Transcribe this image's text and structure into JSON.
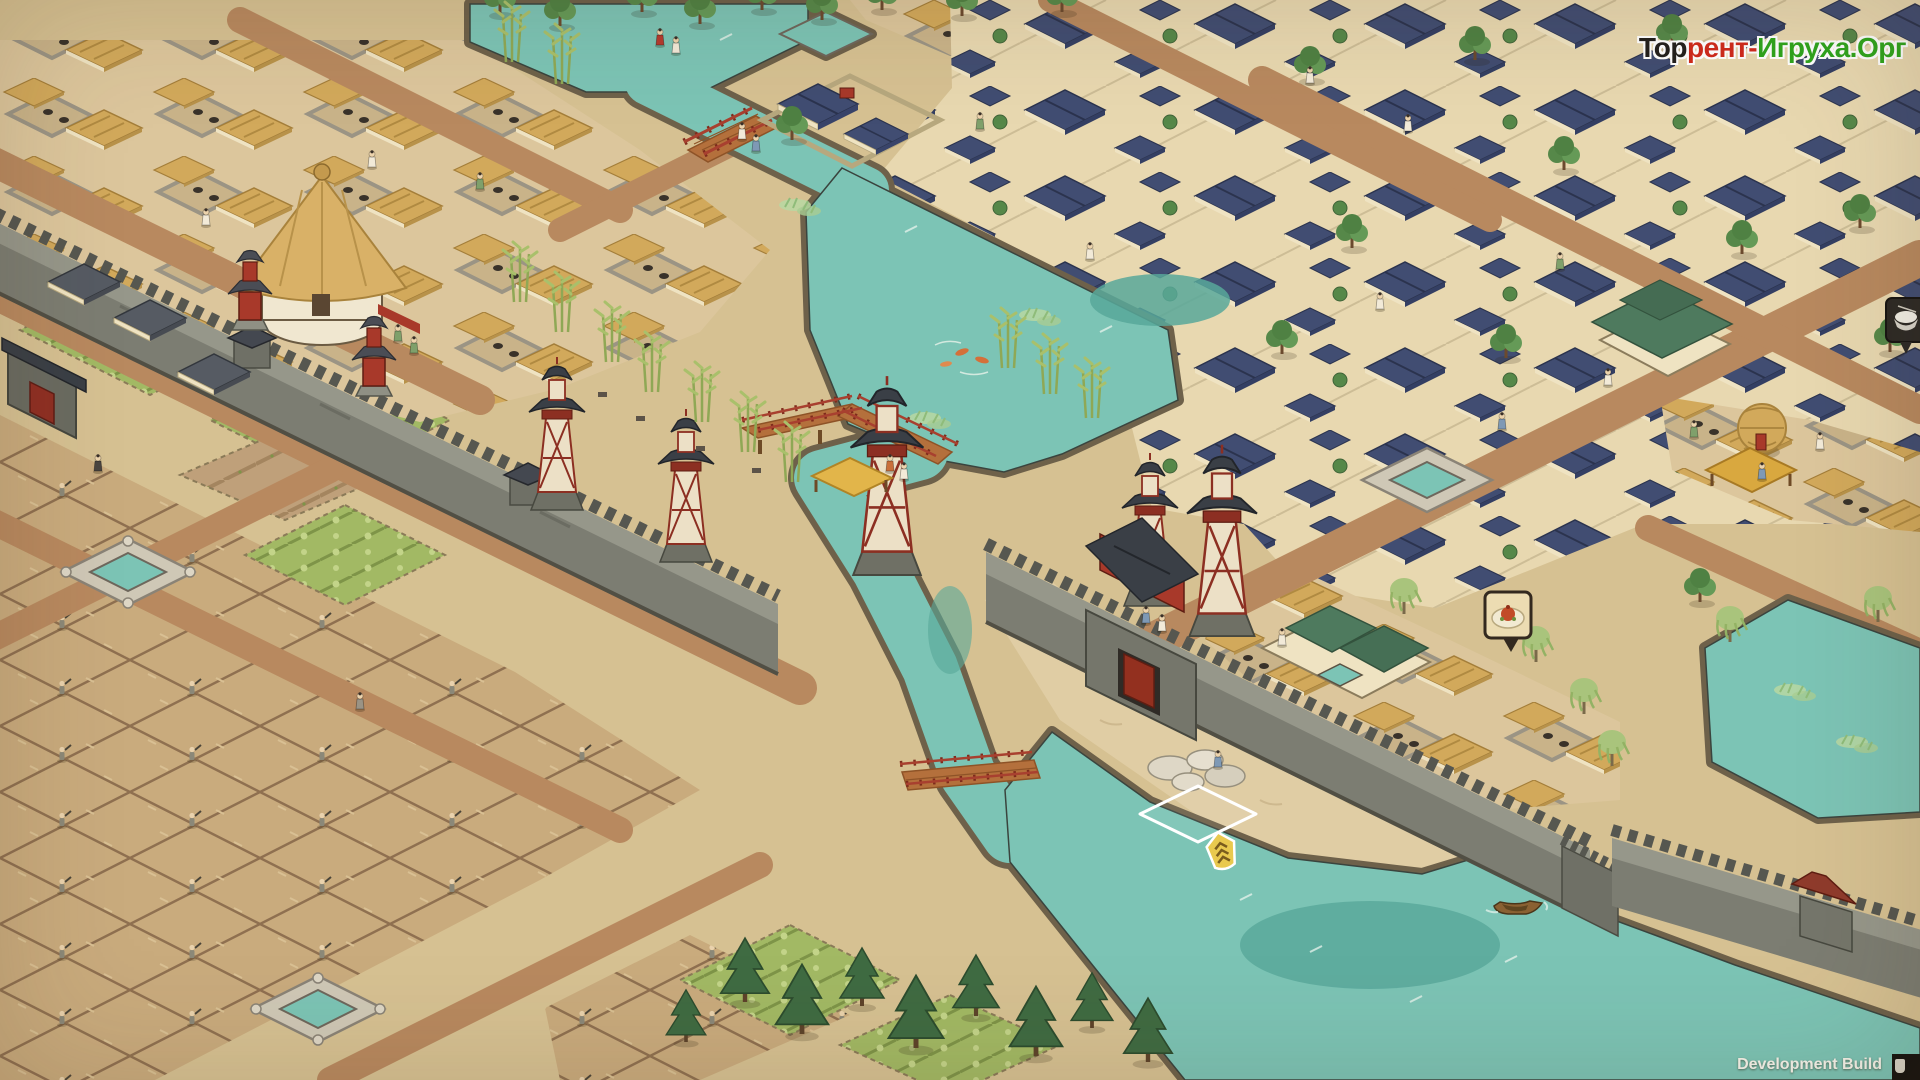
{
  "overlay": {
    "watermark": {
      "segments": [
        {
          "text": "Тор",
          "color": "#23201d"
        },
        {
          "text": "рент-",
          "color": "#d02a1c"
        },
        {
          "text": "Игруха.Орг",
          "color": "#2fa51d"
        }
      ]
    },
    "build_label": "Development Build"
  },
  "markers": {
    "food_bubble": {
      "icon": "food-dish-icon"
    },
    "bowl_bubble": {
      "icon": "rice-bowl-icon"
    },
    "boat_badge": {
      "icon": "boat-badge-icon"
    },
    "tile_cursor": {
      "shape": "diamond-outline",
      "color": "#ffffff"
    }
  },
  "palette": {
    "ground": "#d6c192",
    "ground_light": "#e0cda4",
    "road": "#b8895f",
    "water": "#7cc4b5",
    "water_deep": "#58a89a",
    "bank": "#6e614a",
    "paddy": "#c9ab7d",
    "paddy_line": "#8f7050",
    "crop": "#a2b964",
    "stone": "#7c7d72",
    "stone_top": "#96978a",
    "stone_dark": "#565750",
    "cream": "#efe3c2",
    "thatch": "#d2a95b",
    "thatch_dark": "#a9833c",
    "roof_blue": "#414d72",
    "roof_blue_dark": "#2b334e",
    "roof_green": "#4e7a5e",
    "roof_dark": "#3a3f46",
    "red": "#a8392a",
    "red_dark": "#5e1d12",
    "pine": "#3f6b42",
    "tree": "#568849",
    "bamboo": "#a9c06b",
    "willow": "#a9c47c"
  }
}
